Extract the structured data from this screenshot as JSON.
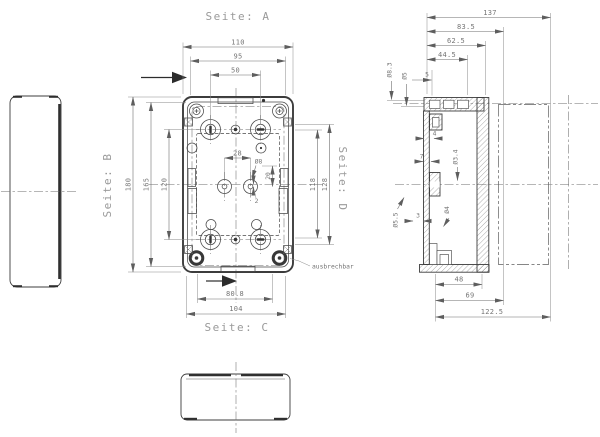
{
  "colors": {
    "line": "#3c3c3c",
    "dim_line": "#6f6f6f",
    "text": "#8a8a8a"
  },
  "titles": {
    "top": "Seite: A",
    "left": "Seite: B",
    "bottom": "Seite: C",
    "right": "Seite: D"
  },
  "annotations": {
    "breakout": "ausbrechbar"
  },
  "main_view": {
    "dim_width_outer": "110",
    "dim_width_inner": "95",
    "dim_boss_spacing_x": "50",
    "dim_height_outer": "180",
    "dim_height_inner": "165",
    "dim_boss_spacing_y": "120",
    "dim_center_boss_spacing": "28",
    "hole_center": "Ø8",
    "dim_offset_20": "20",
    "dim_offset_2": "2",
    "dim_side_latch_span": "118",
    "dim_side_recess_span": "128",
    "dim_breakout_span": "80.8",
    "dim_base_width": "104"
  },
  "section_view": {
    "dim_total_depth": "137",
    "dim_depth_with_cover": "83.5",
    "dim_base_depth": "62.5",
    "dim_inner_depth": "44.5",
    "dim_wall": "5",
    "hole_corner_pocket": "Ø8.3",
    "hole_cover_screw": "Ø5",
    "dim_boss_width": "4",
    "dim_boss_offset": "7",
    "hole_self_tapping": "Ø3.4",
    "hole_mounting": "Ø5.5",
    "dim_foot": "3",
    "hole_foot": "Ø4",
    "dim_bottom_48": "48",
    "dim_bottom_69": "69",
    "dim_bottom_total": "122.5"
  }
}
